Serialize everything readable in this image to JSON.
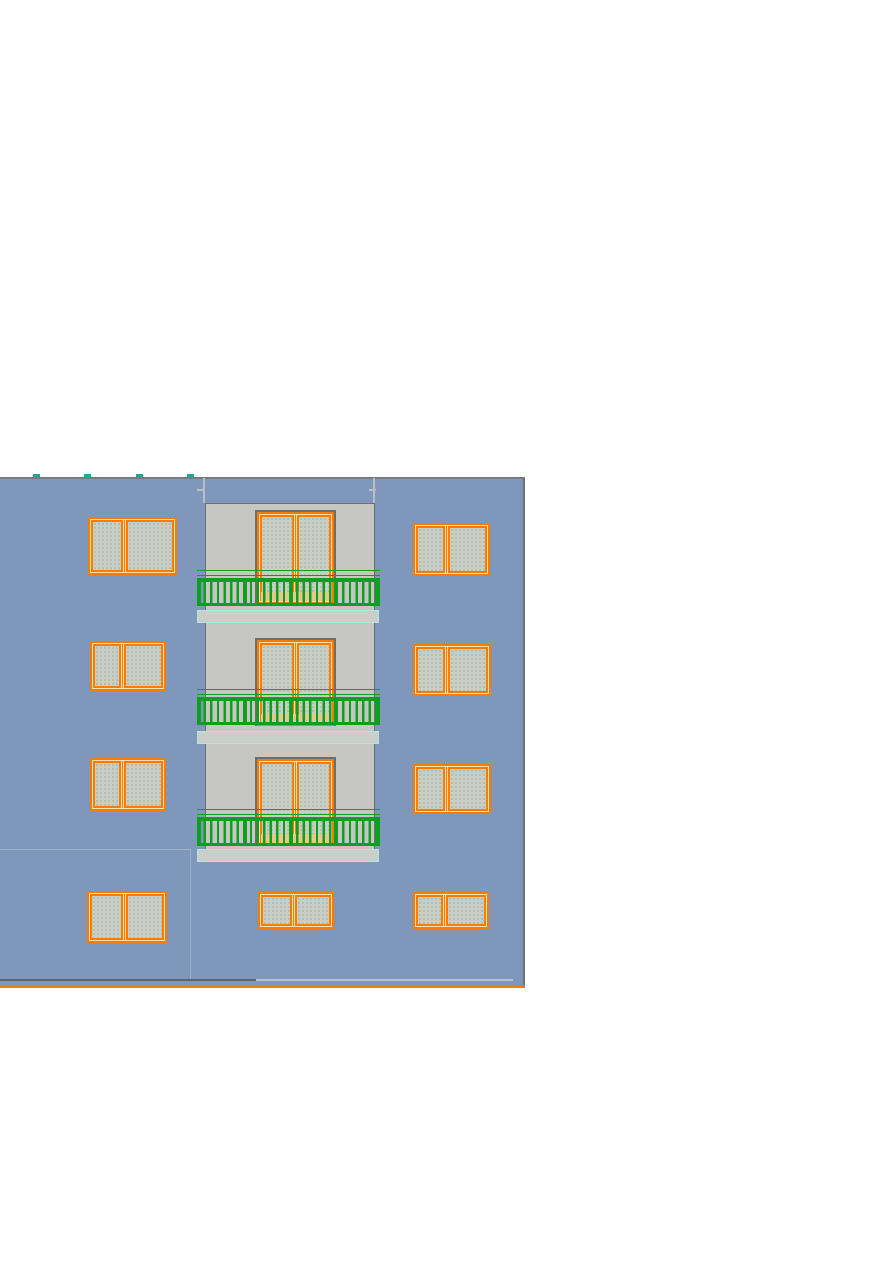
{
  "drawing": {
    "kind": "building-front-elevation",
    "colors": {
      "facade_blue": "#7e97ba",
      "bay_gray": "#c6c7c2",
      "pane_gray": "#c9cec5",
      "frame_orange": "#f87c00",
      "frame_light": "#ffdfae",
      "railing_green": "#0f9f20",
      "slab_fill": "#cccec9",
      "slab_border": "#ace8e0",
      "surround_dark": "#6e6e6e",
      "top_border": "#7a7a7a",
      "right_border": "#6f6f6f",
      "tick_teal": "#18a89d",
      "sill_tan": "#e6c88e",
      "divider_light": "#9db0c8",
      "base_line_dark": "#5f6569",
      "base_line_light": "#b9c2ce"
    },
    "facade": {
      "x": 0,
      "y": 477,
      "w": 525,
      "h": 510
    },
    "ticks": {
      "y": 474,
      "w": 7,
      "h": 3,
      "xs": [
        33,
        84,
        136,
        187
      ]
    },
    "bay": {
      "x": 205,
      "y": 503,
      "w": 170,
      "h": 358
    },
    "floors": [
      {
        "door": {
          "x": 257,
          "y": 512,
          "w": 77,
          "h": 92
        },
        "rail": {
          "x": 197,
          "y": 570,
          "w": 183,
          "h": 36
        },
        "slab": {
          "x": 197,
          "y": 610,
          "w": 182,
          "h": 13
        }
      },
      {
        "door": {
          "x": 257,
          "y": 640,
          "w": 77,
          "h": 86
        },
        "rail": {
          "x": 197,
          "y": 689,
          "w": 183,
          "h": 36
        },
        "slab": {
          "x": 197,
          "y": 731,
          "w": 182,
          "h": 13
        }
      },
      {
        "door": {
          "x": 257,
          "y": 759,
          "w": 77,
          "h": 87
        },
        "rail": {
          "x": 197,
          "y": 809,
          "w": 183,
          "h": 37
        },
        "slab": {
          "x": 197,
          "y": 849,
          "w": 182,
          "h": 13
        }
      }
    ],
    "windows": [
      {
        "x": 88,
        "y": 517,
        "w": 89,
        "h": 58,
        "split": 0.4
      },
      {
        "x": 413,
        "y": 523,
        "w": 77,
        "h": 53,
        "split": 0.42
      },
      {
        "x": 90,
        "y": 641,
        "w": 76,
        "h": 50,
        "split": 0.42
      },
      {
        "x": 413,
        "y": 644,
        "w": 78,
        "h": 52,
        "split": 0.42
      },
      {
        "x": 90,
        "y": 758,
        "w": 76,
        "h": 53,
        "split": 0.42
      },
      {
        "x": 413,
        "y": 764,
        "w": 78,
        "h": 50,
        "split": 0.42
      },
      {
        "x": 87,
        "y": 891,
        "w": 80,
        "h": 52,
        "split": 0.46
      },
      {
        "x": 258,
        "y": 892,
        "w": 76,
        "h": 37,
        "split": 0.46
      },
      {
        "x": 413,
        "y": 892,
        "w": 76,
        "h": 37,
        "split": 0.4
      }
    ],
    "marks": [
      {
        "name": "bay-wall-stub-left",
        "x": 203,
        "y": 478,
        "w": 2,
        "h": 25,
        "color": "#b9bec4"
      },
      {
        "name": "bay-wall-stub-right",
        "x": 373,
        "y": 478,
        "w": 2,
        "h": 25,
        "color": "#b9bec4"
      },
      {
        "name": "bay-step-mark-left",
        "x": 197,
        "y": 489,
        "w": 7,
        "h": 2,
        "color": "#b9bec4"
      },
      {
        "name": "bay-step-mark-right",
        "x": 369,
        "y": 489,
        "w": 7,
        "h": 2,
        "color": "#b9bec4"
      },
      {
        "name": "ground-split-line-h",
        "x": 0,
        "y": 849,
        "w": 191,
        "h": 1,
        "color": "#9db0c8"
      },
      {
        "name": "ground-split-line-v",
        "x": 190,
        "y": 849,
        "w": 1,
        "h": 131,
        "color": "#9db0c8"
      },
      {
        "name": "base-line-dark",
        "x": 0,
        "y": 979,
        "w": 256,
        "h": 2,
        "color": "#5f6569"
      },
      {
        "name": "base-line-light",
        "x": 256,
        "y": 979,
        "w": 257,
        "h": 2,
        "color": "#b9c2ce"
      },
      {
        "name": "base-line-orange",
        "x": 0,
        "y": 985,
        "w": 525,
        "h": 3,
        "color": "#f87c00"
      }
    ]
  }
}
